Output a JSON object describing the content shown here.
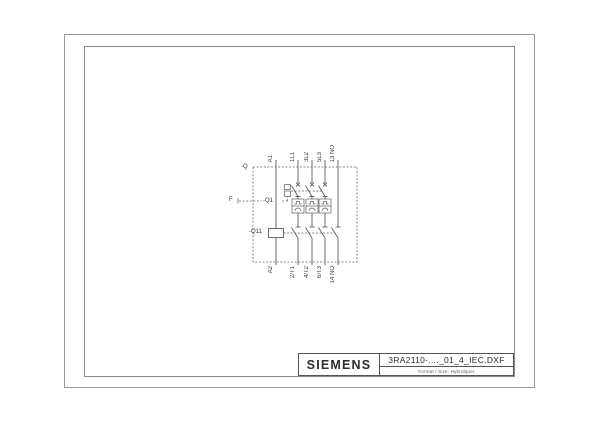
{
  "title_block": {
    "brand": "SIEMENS",
    "drawing_number": "3RA2110-...._01_4_IEC.DXF",
    "format_note": "Format / Size: Hybridquer"
  },
  "schematic": {
    "enclosure_label": "-Q",
    "release_label": "F",
    "breaker_label": "-Q1",
    "contactor_label": "-Q11",
    "top_terminals": [
      "A1",
      "1L1",
      "3L2",
      "5L3",
      "13 NO"
    ],
    "bottom_terminals": [
      "A2",
      "2/T1",
      "4/T2",
      "6/T3",
      "14 NO"
    ]
  },
  "colors": {
    "line": "#666666",
    "frame": "#999999",
    "text": "#333333",
    "background": "#ffffff"
  }
}
